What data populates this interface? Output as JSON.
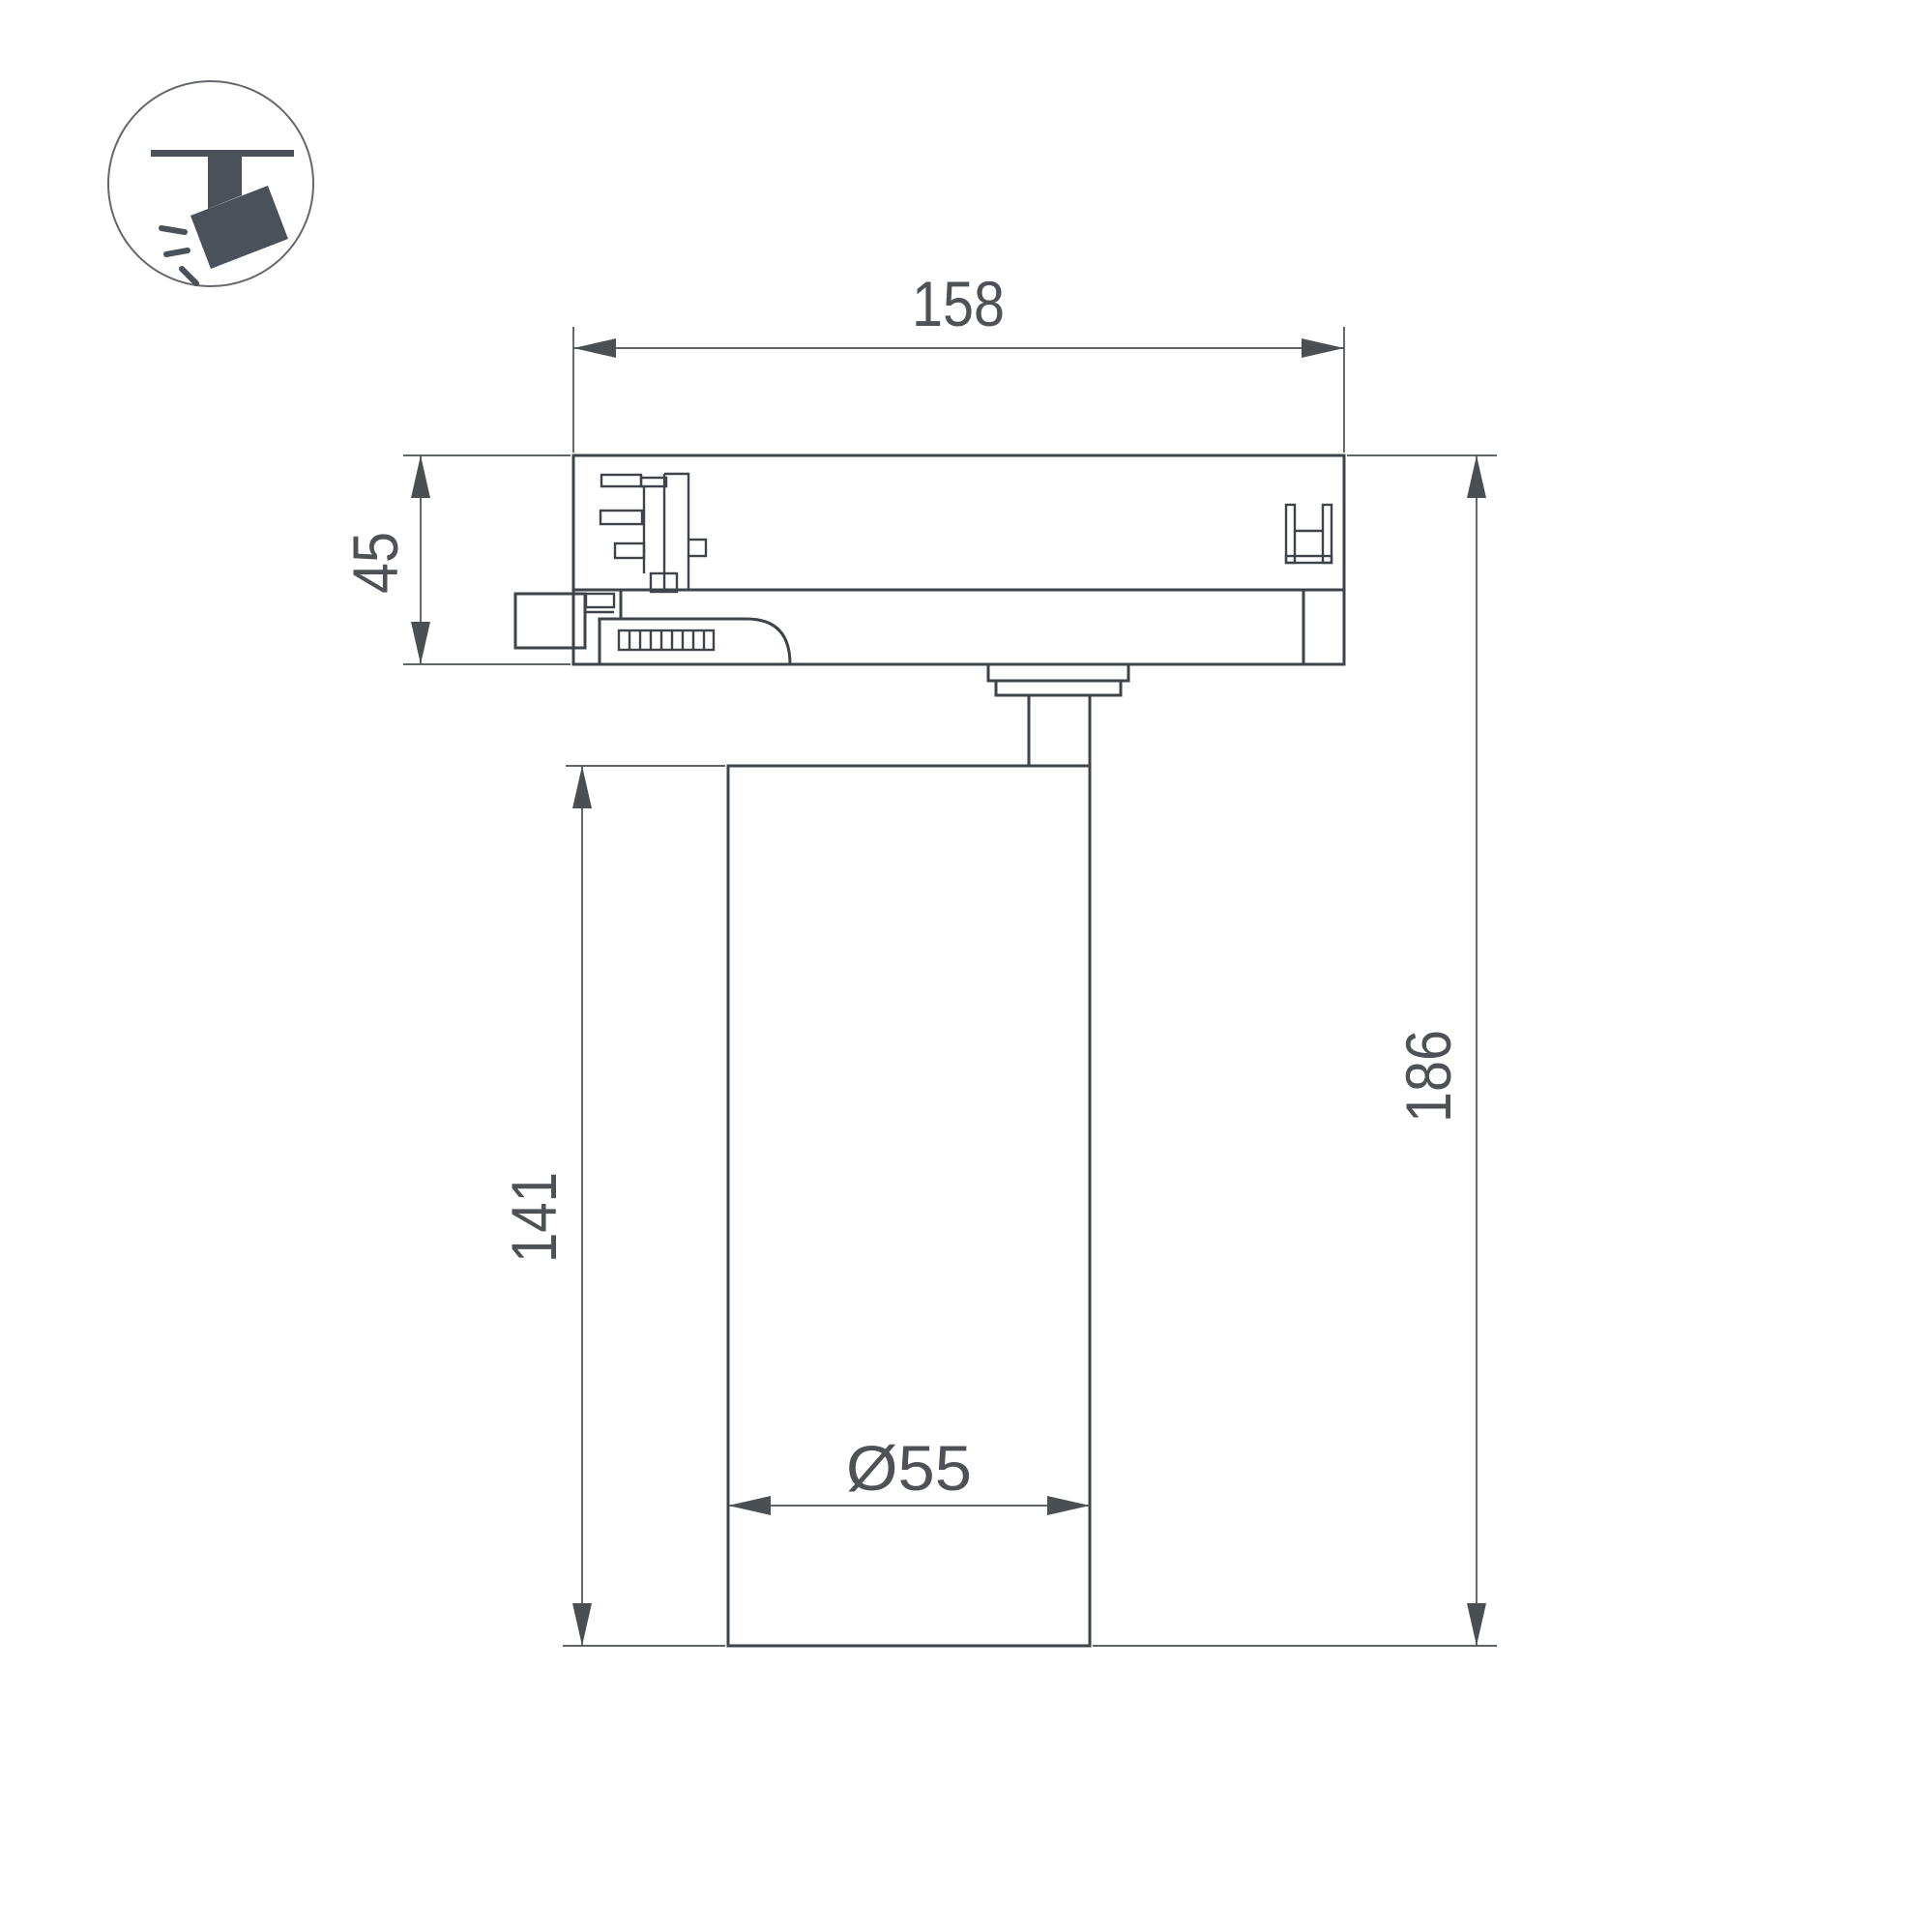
{
  "page": {
    "type": "technical-dimension-drawing",
    "product": "track-mounted spotlight"
  },
  "icon": {
    "name": "track-spotlight-icon"
  },
  "dimensions": {
    "track_width": "158",
    "adapter_height": "45",
    "body_height": "141",
    "total_height": "186",
    "body_diameter": "Ø55"
  },
  "colors": {
    "background": "#ffffff",
    "line": "#3f444a",
    "dim_line": "#4a4f54",
    "text": "#4e5256",
    "icon": "#4a5158",
    "circle_border": "#64686d"
  }
}
